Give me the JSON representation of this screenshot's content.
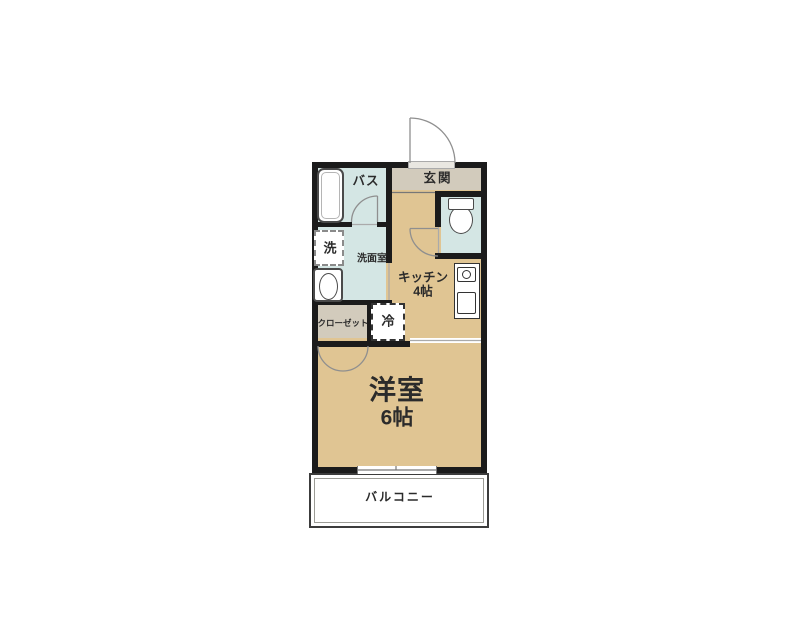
{
  "colors": {
    "wall": "#1b1b1b",
    "room_tan": "#e0c593",
    "room_blue": "#d4e6e4",
    "room_gray": "#d2cbbc",
    "text": "#2b2b2b",
    "door_line": "#8f8f8f",
    "threshold_line": "#aaaaaa",
    "fixture_outline": "#4a4a4a",
    "balcony_border": "#3c3c3c"
  },
  "floor_plan": {
    "entrance": {
      "label": "玄関"
    },
    "bath": {
      "label": "バス"
    },
    "washroom": {
      "label": "洗面室"
    },
    "washer": {
      "label": "洗"
    },
    "kitchen": {
      "label": "キッチン",
      "size": "4帖"
    },
    "fridge": {
      "label": "冷"
    },
    "closet": {
      "label": "クローゼット"
    },
    "western_room": {
      "label": "洋室",
      "size": "6帖"
    },
    "balcony": {
      "label": "バルコニー"
    }
  }
}
